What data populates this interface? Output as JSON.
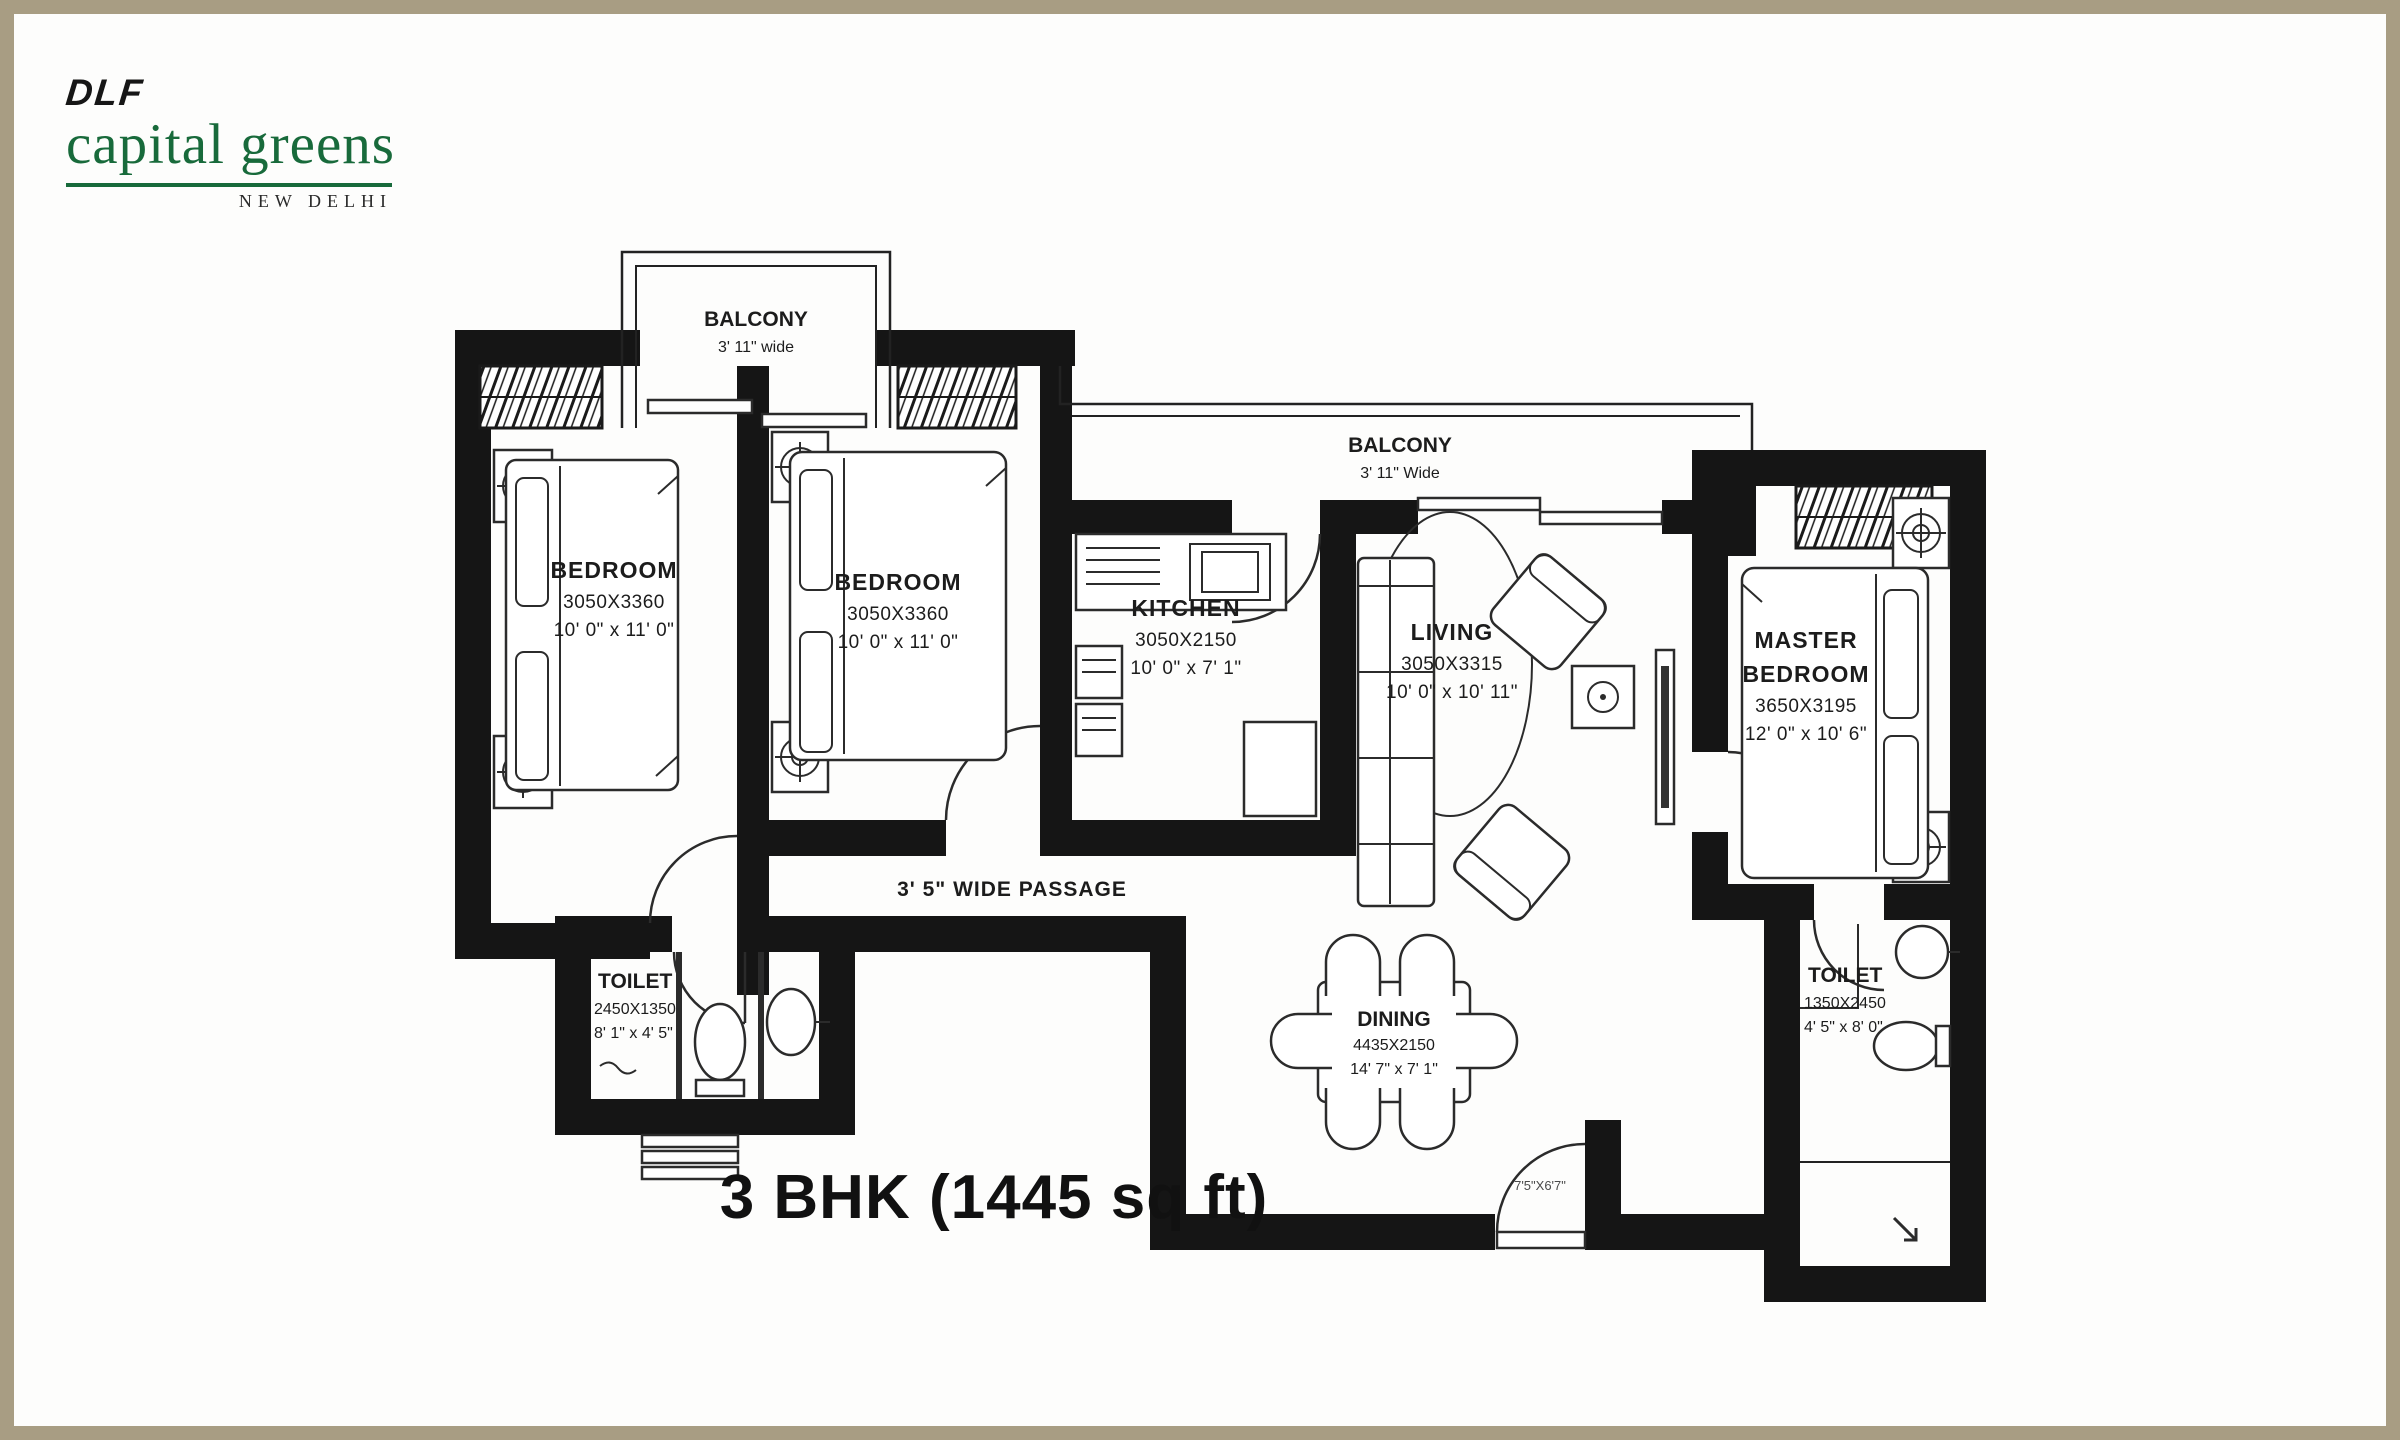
{
  "brand": {
    "dlf": "DLF",
    "name": "capital greens",
    "city": "NEW DELHI"
  },
  "title": "3 BHK (1445 sq ft)",
  "rooms": {
    "bedroom1": {
      "name": "BEDROOM",
      "mm": "3050X3360",
      "ft": "10' 0\" x 11' 0\""
    },
    "bedroom2": {
      "name": "BEDROOM",
      "mm": "3050X3360",
      "ft": "10' 0\" x 11' 0\""
    },
    "kitchen": {
      "name": "KITCHEN",
      "mm": "3050X2150",
      "ft": "10' 0\" x 7' 1\""
    },
    "living": {
      "name": "LIVING",
      "mm": "3050X3315",
      "ft": "10' 0\" x 10' 11\""
    },
    "master": {
      "name_line1": "MASTER",
      "name_line2": "BEDROOM",
      "mm": "3650X3195",
      "ft": "12' 0\" x 10' 6\""
    },
    "dining": {
      "name": "DINING",
      "mm": "4435X2150",
      "ft": "14' 7\" x 7' 1\""
    },
    "toilet_left": {
      "name": "TOILET",
      "mm": "2450X1350",
      "ft": "8' 1\" x 4' 5\""
    },
    "toilet_right": {
      "name": "TOILET",
      "mm": "1350X2450",
      "ft": "4' 5\" x 8' 0\""
    },
    "balcony_top": {
      "name": "BALCONY",
      "width": "3' 11\" wide"
    },
    "balcony_mid": {
      "name": "BALCONY",
      "width": "3' 11\" Wide"
    },
    "passage": {
      "label": "3' 5\" WIDE PASSAGE"
    },
    "entry": {
      "dim": "7'5\"X6'7\""
    }
  },
  "colors": {
    "wall": "#151515",
    "brand_green": "#186a3b",
    "border_tan": "#a89d83"
  }
}
